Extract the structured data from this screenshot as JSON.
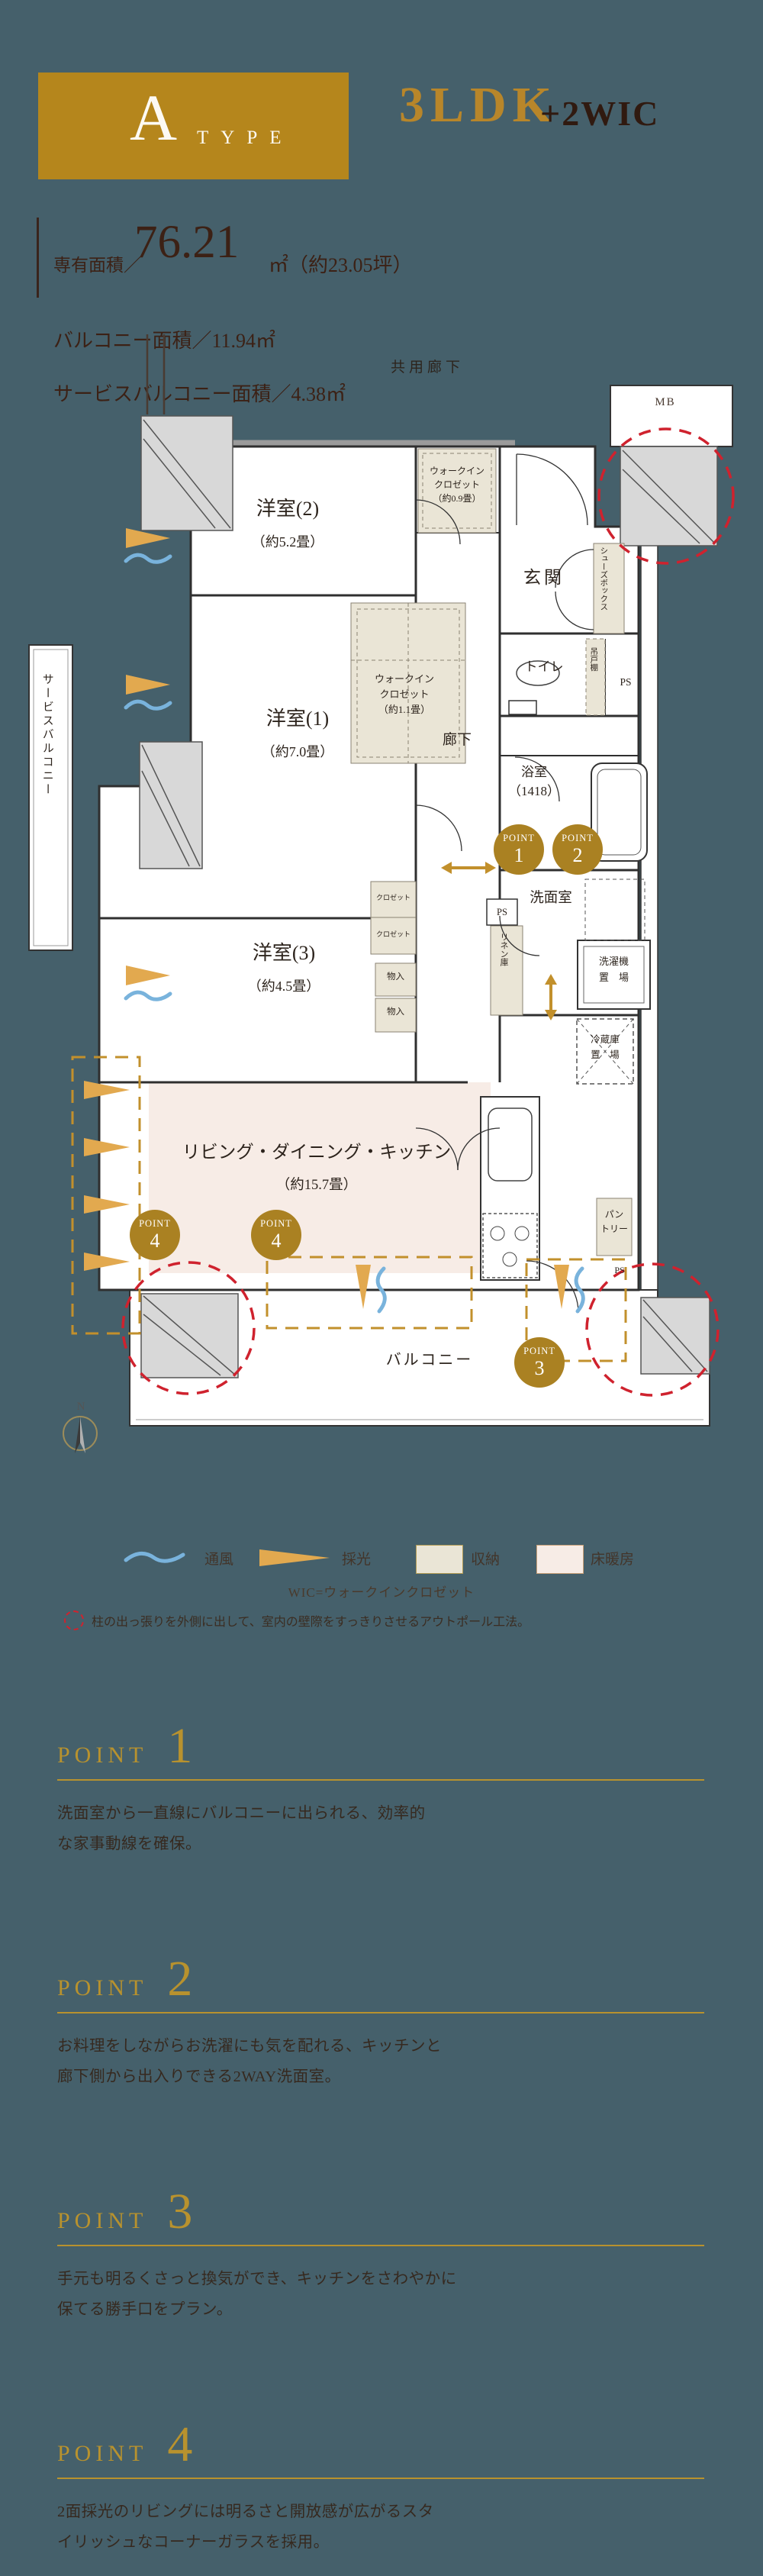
{
  "header": {
    "type_letter": "A",
    "type_word": "TYPE",
    "layout": "3LDK",
    "layout_suffix": "+2WIC"
  },
  "area_info": {
    "label": "専有面積／",
    "value": "76.21",
    "unit": "㎡（約23.05坪）",
    "balcony": "バルコニー面積／11.94㎡",
    "service_balcony": "サービスバルコニー面積／4.38㎡"
  },
  "plan": {
    "shared_corridor": "共用廊下",
    "mb": "MB",
    "room2": {
      "name": "洋室(2)",
      "size": "（約5.2畳）"
    },
    "room1": {
      "name": "洋室(1)",
      "size": "（約7.0畳）"
    },
    "room3": {
      "name": "洋室(3)",
      "size": "（約4.5畳）"
    },
    "ldk": {
      "name": "リビング・ダイニング・キッチン",
      "size": "（約15.7畳）"
    },
    "wic09": "ウォークイン\nクロゼット\n（約0.9畳）",
    "wic11": "ウォークイン\nクロゼット\n（約1.1畳）",
    "entrance": "玄関",
    "shoe_box": "シューズボックス",
    "toilet": "トイレ",
    "hanging_shelf": "吊戸棚",
    "ps": "PS",
    "hallway": "廊下",
    "bathroom": "浴室\n（1418）",
    "washroom": "洗面室",
    "linen": "リネン庫",
    "washer": "洗濯機\n置　場",
    "fridge": "冷蔵庫\n置　場",
    "closet": "クロゼット",
    "storage": "物入",
    "pantry": "パン\nトリー",
    "balcony": "バルコニー",
    "service_balcony": "サービスバルコニー",
    "compass_n": "N",
    "point_label": "POINT",
    "point_numbers": [
      "1",
      "2",
      "3",
      "4"
    ]
  },
  "legend": {
    "ventilation": "通風",
    "daylight": "採光",
    "storage": "収納",
    "floor_heating": "床暖房",
    "wic_note": "WIC=ウォークインクロゼット",
    "outpole_note": "柱の出っ張りを外側に出して、室内の壁際をすっきりさせるアウトポール工法。"
  },
  "points": [
    {
      "label": "POINT",
      "number": "1",
      "text": "洗面室から一直線にバルコニーに出られる、効率的\nな家事動線を確保。"
    },
    {
      "label": "POINT",
      "number": "2",
      "text": "お料理をしながらお洗濯にも気を配れる、キッチンと\n廊下側から出入りできる2WAY洗面室。"
    },
    {
      "label": "POINT",
      "number": "3",
      "text": "手元も明るくさっと換気ができ、キッチンをさわやかに\n保てる勝手口をプラン。"
    },
    {
      "label": "POINT",
      "number": "4",
      "text": "2面採光のリビングには明るさと開放感が広がるスタ\nイリッシュなコーナーガラスを採用。"
    }
  ],
  "colors": {
    "background": "#45606b",
    "brand_gold": "#b5861c",
    "accent_gold": "#b8922e",
    "dark_text": "#36291f",
    "red_dashed": "#cf222e",
    "blue_wave": "#79b3dc",
    "orange_daylight": "#e2a94f",
    "closet_beige": "#eae5d6",
    "floor_heating_pink": "#f7ece6"
  }
}
